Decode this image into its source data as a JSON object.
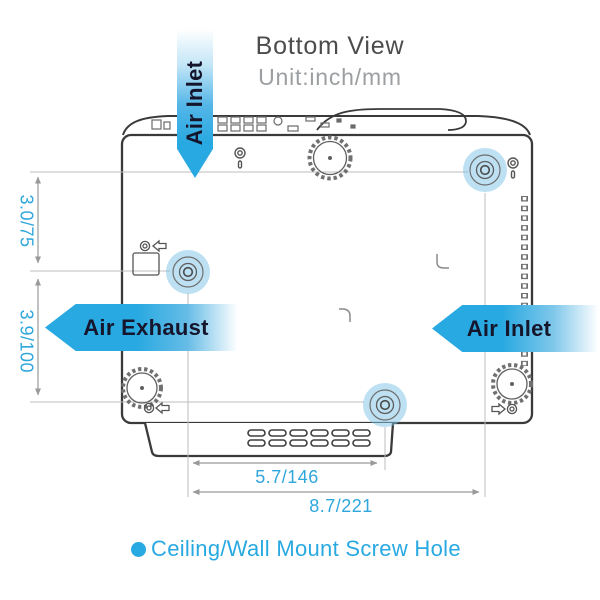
{
  "title": {
    "heading": "Bottom View",
    "unit": "Unit:inch/mm"
  },
  "banners": {
    "top_air_inlet": "Air Inlet",
    "left_air_exhaust": "Air Exhaust",
    "right_air_inlet": "Air Inlet"
  },
  "dimensions": {
    "left_upper": "3.0/75",
    "left_lower": "3.9/100",
    "bottom_inner": "5.7/146",
    "bottom_outer": "8.7/221"
  },
  "legend": {
    "label": "Ceiling/Wall Mount Screw Hole"
  },
  "colors": {
    "accent_blue": "#29a9e1",
    "screw_hole_highlight": "#a9d8f0",
    "outline_dark": "#3a3a3a",
    "dimension_line": "#9a9a9a",
    "title_text": "#4c4c4c",
    "unit_text": "#9c9c9c",
    "banner_text": "#15152c"
  }
}
